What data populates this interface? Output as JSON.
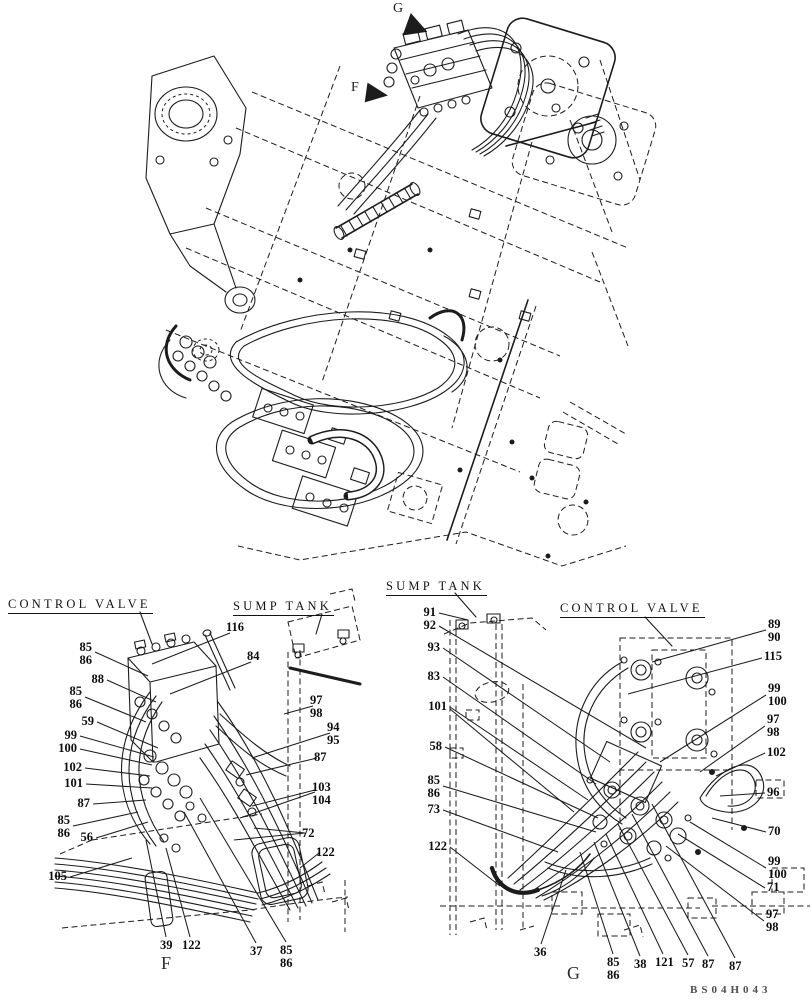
{
  "page": {
    "background": "#ffffff",
    "ink": "#1c1c1c"
  },
  "drawing_code": "BS04H043",
  "top_view": {
    "view_letters": [
      {
        "text": "G",
        "x": 393,
        "y": 1
      },
      {
        "text": "F",
        "x": 351,
        "y": 80
      }
    ]
  },
  "detail_f": {
    "titles": [
      {
        "id": "control-valve",
        "text": "CONTROL VALVE",
        "x": 8,
        "y": 597
      },
      {
        "id": "sump-tank",
        "text": "SUMP TANK",
        "x": 233,
        "y": 599
      }
    ],
    "view_letter": {
      "text": "F",
      "x": 161,
      "y": 953
    },
    "callouts": [
      {
        "lines": [
          "85",
          "86"
        ],
        "x": 92,
        "y": 641,
        "align": "right",
        "leaders": [
          [
            95,
            652,
            148,
            676
          ]
        ]
      },
      {
        "lines": [
          "88"
        ],
        "x": 104,
        "y": 673,
        "align": "right",
        "leaders": [
          [
            107,
            680,
            156,
            702
          ]
        ]
      },
      {
        "lines": [
          "85",
          "86"
        ],
        "x": 82,
        "y": 685,
        "align": "right",
        "leaders": [
          [
            85,
            697,
            146,
            722
          ]
        ]
      },
      {
        "lines": [
          "59"
        ],
        "x": 94,
        "y": 715,
        "align": "right",
        "leaders": [
          [
            97,
            722,
            158,
            748
          ]
        ]
      },
      {
        "lines": [
          "99"
        ],
        "x": 77,
        "y": 729,
        "align": "right",
        "leaders": [
          [
            80,
            736,
            154,
            757
          ]
        ]
      },
      {
        "lines": [
          "100"
        ],
        "x": 77,
        "y": 742,
        "align": "right",
        "leaders": [
          [
            80,
            749,
            152,
            765
          ]
        ]
      },
      {
        "lines": [
          "102"
        ],
        "x": 82,
        "y": 761,
        "align": "right",
        "leaders": [
          [
            85,
            768,
            150,
            776
          ]
        ]
      },
      {
        "lines": [
          "101"
        ],
        "x": 83,
        "y": 777,
        "align": "right",
        "leaders": [
          [
            86,
            784,
            152,
            788
          ]
        ]
      },
      {
        "lines": [
          "87"
        ],
        "x": 90,
        "y": 797,
        "align": "right",
        "leaders": [
          [
            93,
            804,
            146,
            800
          ]
        ]
      },
      {
        "lines": [
          "85",
          "86"
        ],
        "x": 70,
        "y": 814,
        "align": "right",
        "leaders": [
          [
            73,
            826,
            138,
            812
          ]
        ]
      },
      {
        "lines": [
          "56"
        ],
        "x": 93,
        "y": 831,
        "align": "right",
        "leaders": [
          [
            96,
            838,
            148,
            822
          ]
        ]
      },
      {
        "lines": [
          "105"
        ],
        "x": 67,
        "y": 870,
        "align": "right",
        "leaders": [
          [
            70,
            877,
            132,
            858
          ]
        ]
      },
      {
        "lines": [
          "116"
        ],
        "x": 226,
        "y": 621,
        "align": "left",
        "leaders": [
          [
            230,
            633,
            152,
            664
          ]
        ]
      },
      {
        "lines": [
          "84"
        ],
        "x": 247,
        "y": 650,
        "align": "left",
        "leaders": [
          [
            251,
            662,
            170,
            694
          ]
        ]
      },
      {
        "lines": [
          "97",
          "98"
        ],
        "x": 310,
        "y": 694,
        "align": "left",
        "leaders": [
          [
            313,
            706,
            284,
            714
          ]
        ]
      },
      {
        "lines": [
          "94",
          "95"
        ],
        "x": 327,
        "y": 721,
        "align": "left",
        "leaders": [
          [
            330,
            733,
            252,
            758
          ]
        ]
      },
      {
        "lines": [
          "87"
        ],
        "x": 314,
        "y": 751,
        "align": "left",
        "leaders": [
          [
            317,
            758,
            246,
            775
          ]
        ]
      },
      {
        "lines": [
          "103",
          "104"
        ],
        "x": 312,
        "y": 781,
        "align": "left",
        "leaders": [
          [
            315,
            790,
            252,
            806
          ],
          [
            315,
            792,
            240,
            818
          ]
        ]
      },
      {
        "lines": [
          "72"
        ],
        "x": 302,
        "y": 827,
        "align": "left",
        "leaders": [
          [
            305,
            833,
            254,
            828
          ],
          [
            305,
            833,
            234,
            840
          ]
        ]
      },
      {
        "lines": [
          "122"
        ],
        "x": 316,
        "y": 846,
        "align": "left",
        "leaders": [
          [
            319,
            853,
            300,
            868
          ]
        ]
      },
      {
        "lines": [
          "39"
        ],
        "x": 160,
        "y": 939,
        "align": "left",
        "leaders": [
          [
            166,
            937,
            146,
            840
          ]
        ]
      },
      {
        "lines": [
          "122"
        ],
        "x": 182,
        "y": 939,
        "align": "left",
        "leaders": [
          [
            190,
            937,
            166,
            848
          ]
        ]
      },
      {
        "lines": [
          "37"
        ],
        "x": 250,
        "y": 945,
        "align": "left",
        "leaders": [
          [
            256,
            943,
            184,
            812
          ]
        ]
      },
      {
        "lines": [
          "85",
          "86"
        ],
        "x": 280,
        "y": 944,
        "align": "left",
        "leaders": [
          [
            286,
            942,
            200,
            798
          ]
        ]
      }
    ]
  },
  "detail_g": {
    "titles": [
      {
        "id": "sump-tank",
        "text": "SUMP TANK",
        "x": 386,
        "y": 579
      },
      {
        "id": "control-valve",
        "text": "CONTROL VALVE",
        "x": 560,
        "y": 601
      }
    ],
    "view_letter": {
      "text": "G",
      "x": 567,
      "y": 963
    },
    "callouts": [
      {
        "lines": [
          "91"
        ],
        "x": 436,
        "y": 606,
        "align": "right",
        "leaders": [
          [
            439,
            613,
            468,
            620
          ]
        ]
      },
      {
        "lines": [
          "92"
        ],
        "x": 436,
        "y": 619,
        "align": "right",
        "leaders": [
          [
            439,
            626,
            646,
            748
          ]
        ]
      },
      {
        "lines": [
          "93"
        ],
        "x": 440,
        "y": 641,
        "align": "right",
        "leaders": [
          [
            443,
            648,
            610,
            762
          ]
        ]
      },
      {
        "lines": [
          "83"
        ],
        "x": 440,
        "y": 670,
        "align": "right",
        "leaders": [
          [
            443,
            677,
            596,
            784
          ]
        ]
      },
      {
        "lines": [
          "101"
        ],
        "x": 447,
        "y": 700,
        "align": "right",
        "leaders": [
          [
            450,
            707,
            588,
            800
          ],
          [
            450,
            709,
            574,
            812
          ]
        ]
      },
      {
        "lines": [
          "58"
        ],
        "x": 442,
        "y": 740,
        "align": "right",
        "leaders": [
          [
            445,
            747,
            598,
            818
          ]
        ]
      },
      {
        "lines": [
          "85",
          "86"
        ],
        "x": 440,
        "y": 774,
        "align": "right",
        "leaders": [
          [
            443,
            786,
            596,
            832
          ]
        ]
      },
      {
        "lines": [
          "73"
        ],
        "x": 440,
        "y": 803,
        "align": "right",
        "leaders": [
          [
            443,
            810,
            558,
            852
          ]
        ]
      },
      {
        "lines": [
          "122"
        ],
        "x": 447,
        "y": 840,
        "align": "right",
        "leaders": [
          [
            450,
            847,
            500,
            886
          ]
        ]
      },
      {
        "lines": [
          "36"
        ],
        "x": 534,
        "y": 946,
        "align": "left",
        "leaders": [
          [
            541,
            944,
            566,
            870
          ]
        ]
      },
      {
        "lines": [
          "85",
          "86"
        ],
        "x": 607,
        "y": 956,
        "align": "left",
        "leaders": [
          [
            613,
            954,
            580,
            852
          ]
        ]
      },
      {
        "lines": [
          "38"
        ],
        "x": 634,
        "y": 958,
        "align": "left",
        "leaders": [
          [
            640,
            956,
            594,
            842
          ]
        ]
      },
      {
        "lines": [
          "121"
        ],
        "x": 655,
        "y": 956,
        "align": "left",
        "leaders": [
          [
            663,
            954,
            606,
            834
          ]
        ]
      },
      {
        "lines": [
          "57"
        ],
        "x": 682,
        "y": 957,
        "align": "left",
        "leaders": [
          [
            688,
            955,
            618,
            824
          ]
        ]
      },
      {
        "lines": [
          "87"
        ],
        "x": 702,
        "y": 958,
        "align": "left",
        "leaders": [
          [
            708,
            956,
            632,
            814
          ]
        ]
      },
      {
        "lines": [
          "87"
        ],
        "x": 729,
        "y": 960,
        "align": "left",
        "leaders": [
          [
            735,
            958,
            652,
            804
          ]
        ]
      },
      {
        "lines": [
          "89",
          "90"
        ],
        "x": 768,
        "y": 618,
        "align": "left",
        "leaders": [
          [
            766,
            630,
            652,
            662
          ]
        ]
      },
      {
        "lines": [
          "115"
        ],
        "x": 764,
        "y": 650,
        "align": "left",
        "leaders": [
          [
            762,
            658,
            628,
            694
          ]
        ]
      },
      {
        "lines": [
          "99",
          "100"
        ],
        "x": 768,
        "y": 682,
        "align": "left",
        "leaders": [
          [
            766,
            695,
            660,
            762
          ]
        ]
      },
      {
        "lines": [
          "97",
          "98"
        ],
        "x": 767,
        "y": 713,
        "align": "left",
        "leaders": [
          [
            765,
            726,
            700,
            772
          ]
        ]
      },
      {
        "lines": [
          "102"
        ],
        "x": 767,
        "y": 746,
        "align": "left",
        "leaders": [
          [
            765,
            753,
            716,
            776
          ]
        ]
      },
      {
        "lines": [
          "96"
        ],
        "x": 767,
        "y": 786,
        "align": "left",
        "leaders": [
          [
            765,
            793,
            720,
            796
          ]
        ]
      },
      {
        "lines": [
          "70"
        ],
        "x": 768,
        "y": 825,
        "align": "left",
        "leaders": [
          [
            766,
            832,
            712,
            818
          ]
        ]
      },
      {
        "lines": [
          "99",
          "100"
        ],
        "x": 768,
        "y": 855,
        "align": "left",
        "leaders": [
          [
            766,
            868,
            690,
            822
          ]
        ]
      },
      {
        "lines": [
          "71"
        ],
        "x": 767,
        "y": 881,
        "align": "left",
        "leaders": [
          [
            765,
            888,
            678,
            834
          ]
        ]
      },
      {
        "lines": [
          "97",
          "98"
        ],
        "x": 766,
        "y": 908,
        "align": "left",
        "leaders": [
          [
            764,
            921,
            666,
            846
          ]
        ]
      }
    ]
  }
}
